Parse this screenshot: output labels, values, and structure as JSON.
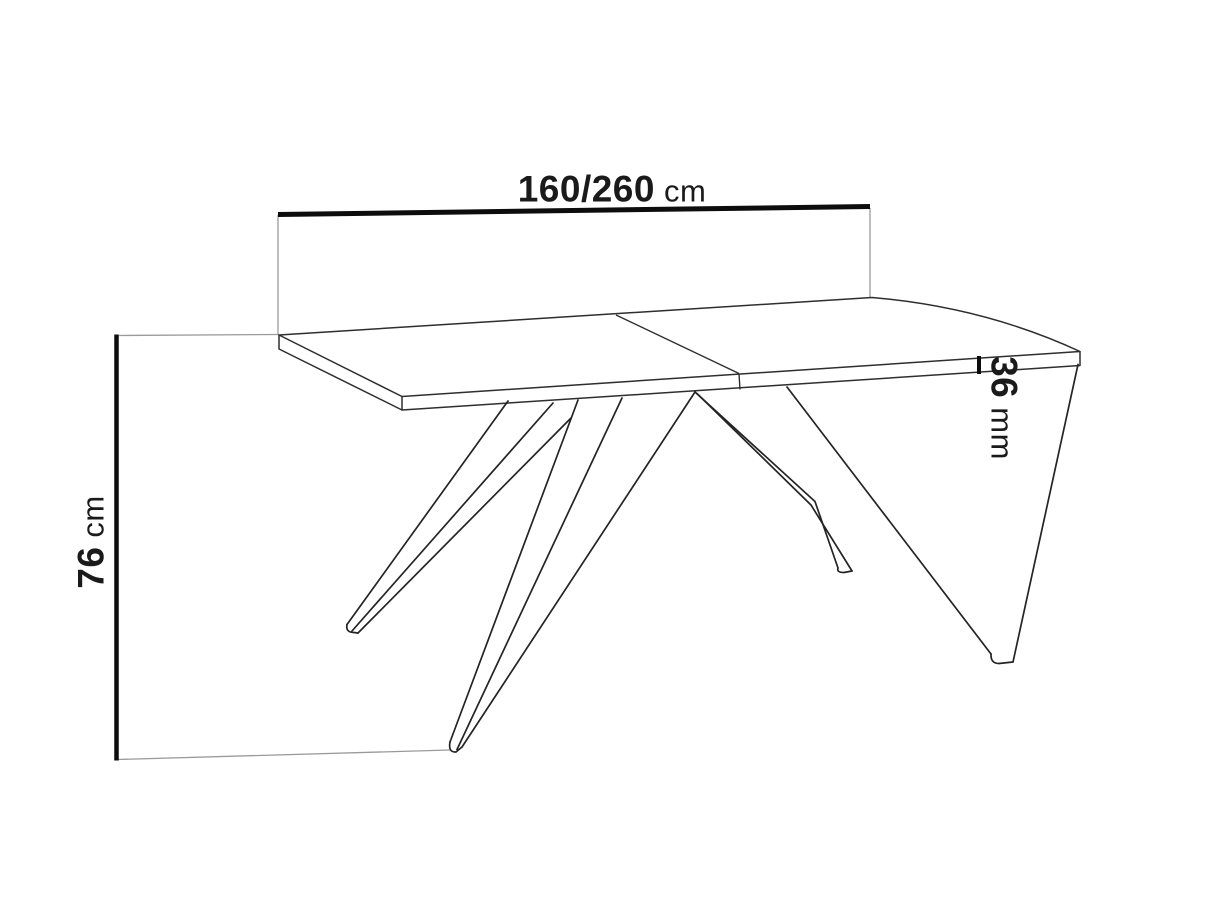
{
  "drawing": {
    "subject": "extendable-table-dimension-drawing",
    "background_color": "#ffffff",
    "outline_color": "#242424",
    "dimension_line_color": "#0d0d0d",
    "extension_line_color": "#9a9a9a",
    "text_color": "#1a1a1a"
  },
  "dimensions": {
    "length": {
      "value": "160/260",
      "unit": "cm"
    },
    "height": {
      "value": "76",
      "unit": "cm"
    },
    "thickness": {
      "value": "36",
      "unit": "mm"
    }
  }
}
